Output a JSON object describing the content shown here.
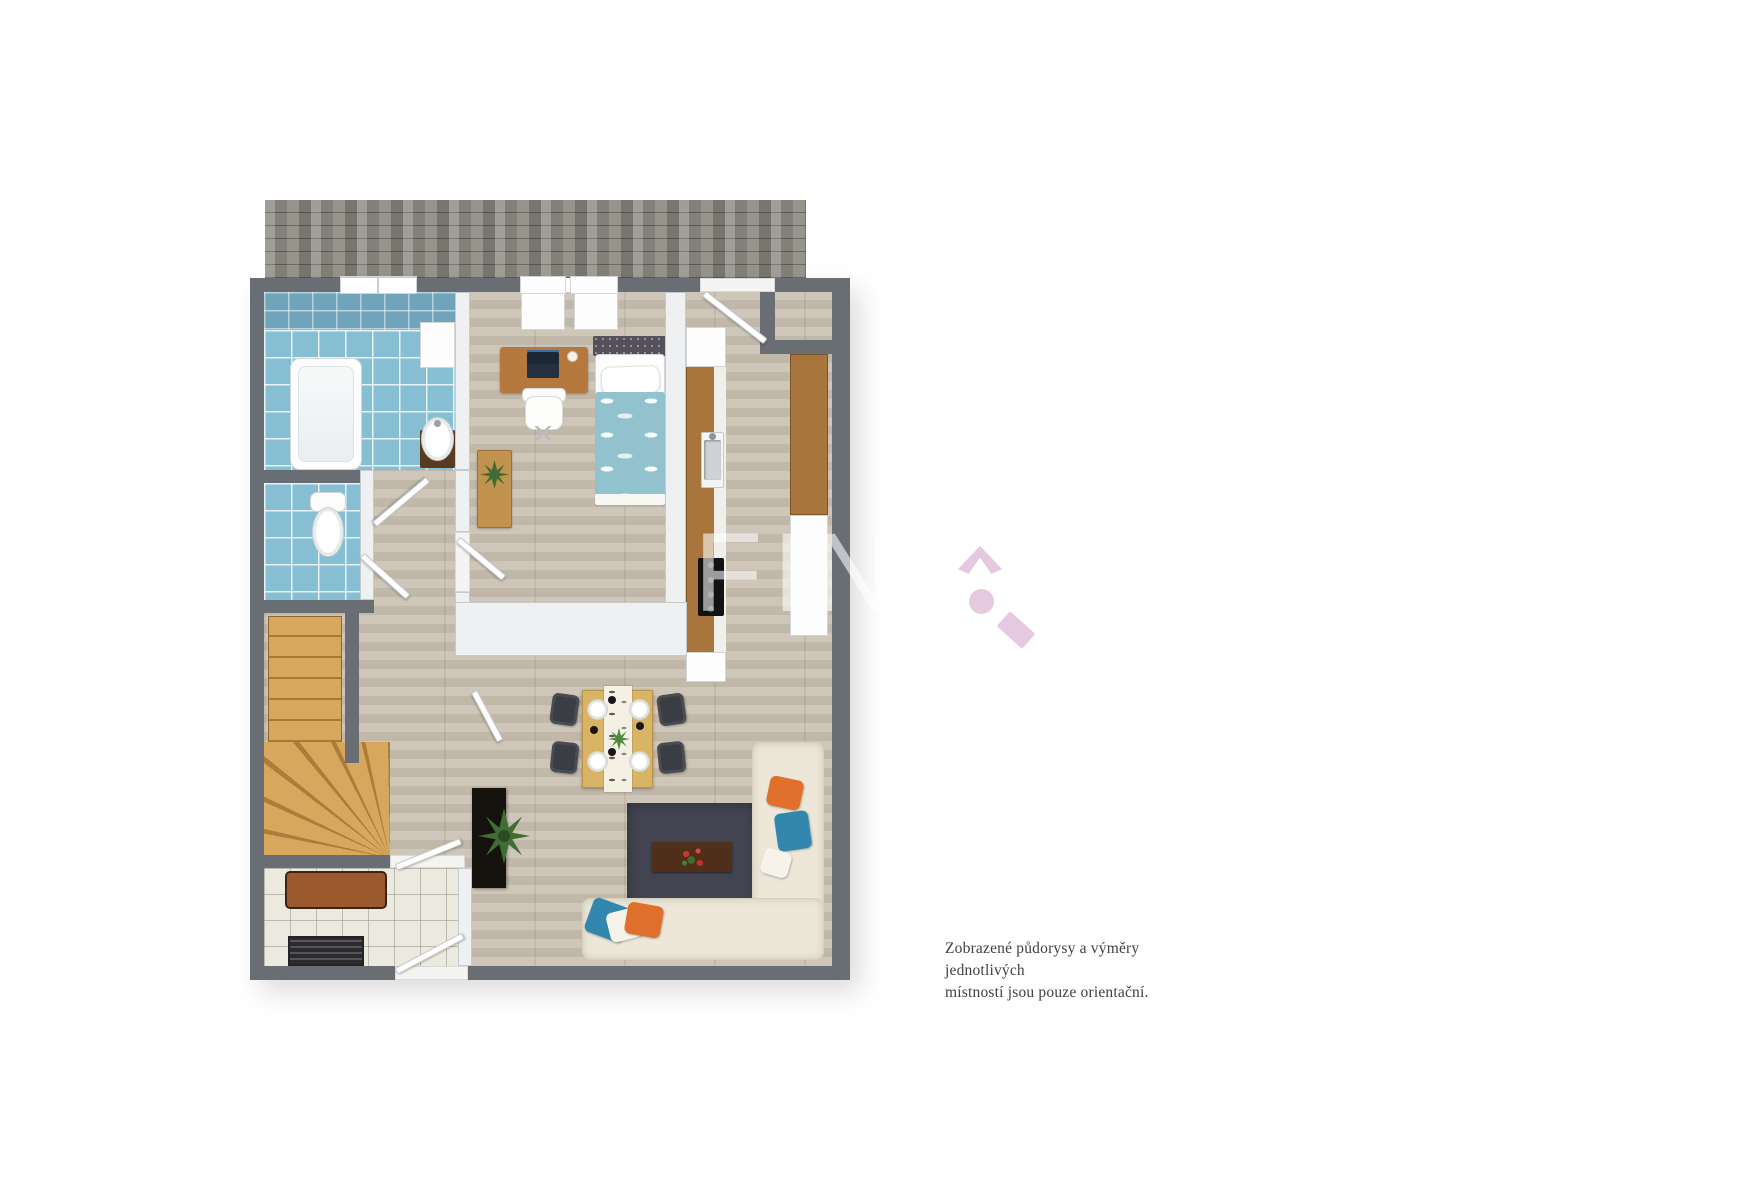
{
  "watermark": {
    "text": "FIN"
  },
  "logo": {
    "name": "magnifier-house-logo",
    "color": "#e6c9e1"
  },
  "disclaimer": {
    "line1": "Zobrazené půdorysy a výměry jednotlivých",
    "line2": "místností jsou pouze orientační."
  },
  "colors": {
    "wall": "#696e75",
    "wallLight": "#eef0f2",
    "paverBase": "#918e85",
    "tileBlue": "#86bed3",
    "tileBlueDark": "#6fa4ba",
    "wood": "#c9c0b1",
    "stairWood": "#d8a75e",
    "counterWood": "#a8753d",
    "tableWood": "#d9b465",
    "rug": "#424551",
    "sofa": "#ece7d8",
    "pillowOrange": "#df6f2a",
    "pillowTeal": "#3187ae",
    "duvet": "#92c2cd",
    "chairDark": "#3a3d43",
    "tvBoard": "#16130f",
    "benchBrown": "#9a5a2d",
    "accentPink": "#e6c9e1",
    "textDark": "#3f3f3f"
  }
}
